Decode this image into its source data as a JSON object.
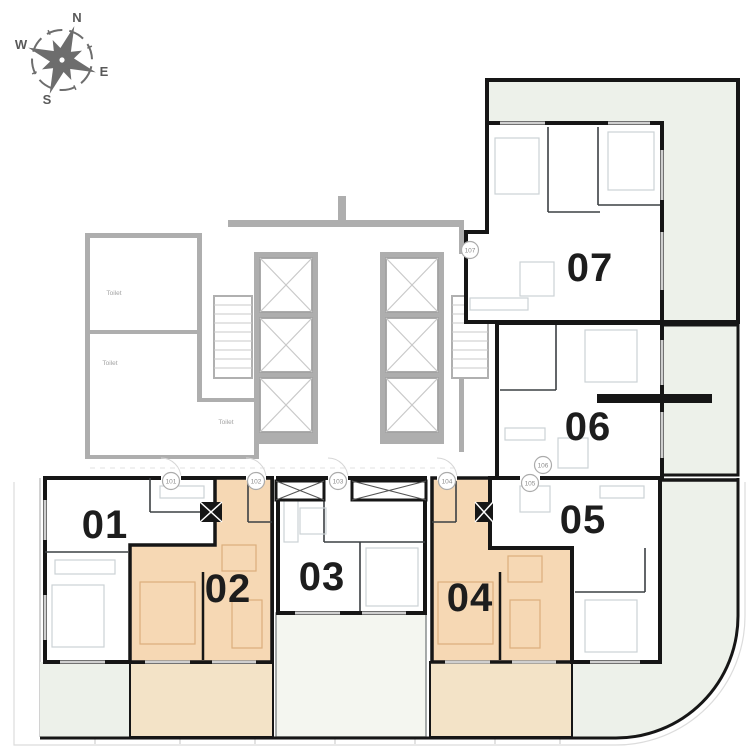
{
  "plan": {
    "type": "residential-floor-plan",
    "highlighted_units": [
      "02",
      "04"
    ]
  },
  "compass": {
    "north": "N",
    "east": "E",
    "south": "S",
    "west": "W"
  },
  "units": [
    {
      "id": "unit-01",
      "label": "01",
      "highlighted": false
    },
    {
      "id": "unit-02",
      "label": "02",
      "highlighted": true
    },
    {
      "id": "unit-03",
      "label": "03",
      "highlighted": false
    },
    {
      "id": "unit-04",
      "label": "04",
      "highlighted": true
    },
    {
      "id": "unit-05",
      "label": "05",
      "highlighted": false
    },
    {
      "id": "unit-06",
      "label": "06",
      "highlighted": false
    },
    {
      "id": "unit-07",
      "label": "07",
      "highlighted": false
    }
  ],
  "door_tags": [
    "101",
    "102",
    "103",
    "104",
    "105",
    "106",
    "107"
  ],
  "room_labels": {
    "toilet": "Toilet"
  },
  "colors": {
    "unit_default": "#ffffff",
    "unit_highlight": "#f6d8b4",
    "balcony_tan": "#f3e3c7",
    "terrace_green": "#edf1ea",
    "balcony_light": "#f4f6f0",
    "core_gray": "#aeaeae",
    "wall_black": "#161616",
    "compass_gray": "#6d6d6d"
  }
}
